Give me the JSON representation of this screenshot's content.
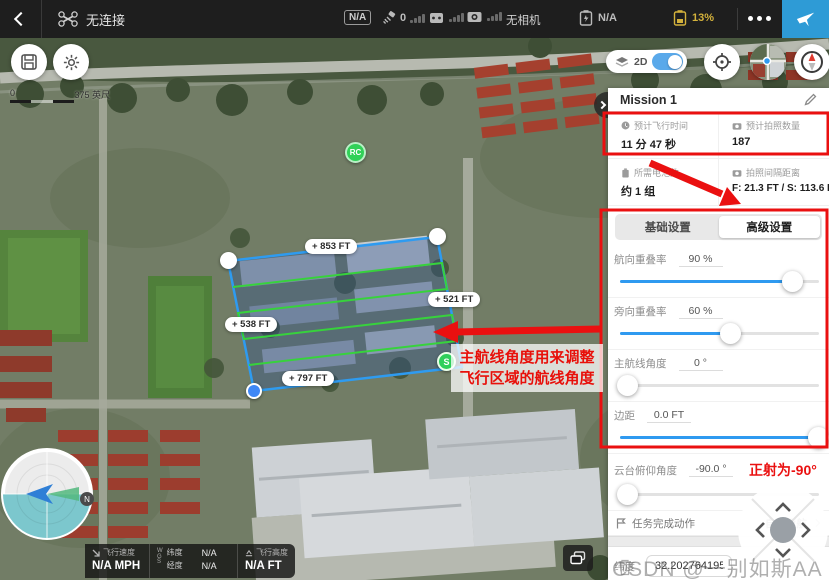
{
  "top_bar": {
    "connection_status": "无连接",
    "flight_mode": "N/A",
    "gps_count": "0",
    "camera_status": "无相机",
    "aircraft_battery": "N/A",
    "rc_battery": "13%"
  },
  "map": {
    "view_toggle": "2D",
    "scale_start": "0",
    "scale_end": "375 英尺",
    "rc_marker": "RC",
    "start_marker": "S",
    "edge_labels": [
      {
        "text": "+ 853 FT"
      },
      {
        "text": "+ 521 FT"
      },
      {
        "text": "+ 538 FT"
      },
      {
        "text": "+ 797 FT"
      }
    ]
  },
  "panel": {
    "title": "Mission 1",
    "stats": [
      {
        "label": "预计飞行时间",
        "value": "11 分 47 秒"
      },
      {
        "label": "预计拍照数量",
        "value": "187"
      },
      {
        "label": "所需电池数",
        "value": "约 1 组"
      },
      {
        "label": "拍照间隔距离",
        "value": "F: 21.3 FT / S: 113.6 FT"
      }
    ],
    "tabs": [
      {
        "label": "基础设置"
      },
      {
        "label": "高级设置"
      }
    ],
    "settings": [
      {
        "label": "航向重叠率",
        "value": "90 %",
        "percent": 87
      },
      {
        "label": "旁向重叠率",
        "value": "60 %",
        "percent": 56
      },
      {
        "label": "主航线角度",
        "value": "0 °",
        "percent": 4
      },
      {
        "label": "边距",
        "value": "0.0 FT",
        "percent": 100
      },
      {
        "label": "云台俯仰角度",
        "value": "-90.0 °",
        "percent": 4,
        "note": "正射为-90°"
      }
    ],
    "finish_action_label": "任务完成动作",
    "finish_action_value": "自动返航",
    "lat_label": "纬度",
    "lat_value": "32.202764195",
    "lng_label": "经度",
    "lng_value": "118.716763493"
  },
  "telemetry": {
    "speed_label": "飞行速度",
    "speed_value": "N/A MPH",
    "gps_system": "WGS",
    "lat_label": "纬度",
    "lat_value": "N/A",
    "lng_label": "经度",
    "lng_value": "N/A",
    "alt_label": "飞行高度",
    "alt_value": "N/A FT"
  },
  "annotations": {
    "line1": "主航线角度用来调整",
    "line2": "飞行区域的航线角度",
    "gimbal_note": "正射为-90°"
  },
  "watermark": "CSDN @一别如斯AA",
  "colors": {
    "accent_blue": "#2f9af0",
    "annotation_red": "#ea1010",
    "battery_warning": "#d4b23c",
    "path_green": "#37d23c",
    "takeoff_blue": "#2e9bd6"
  }
}
